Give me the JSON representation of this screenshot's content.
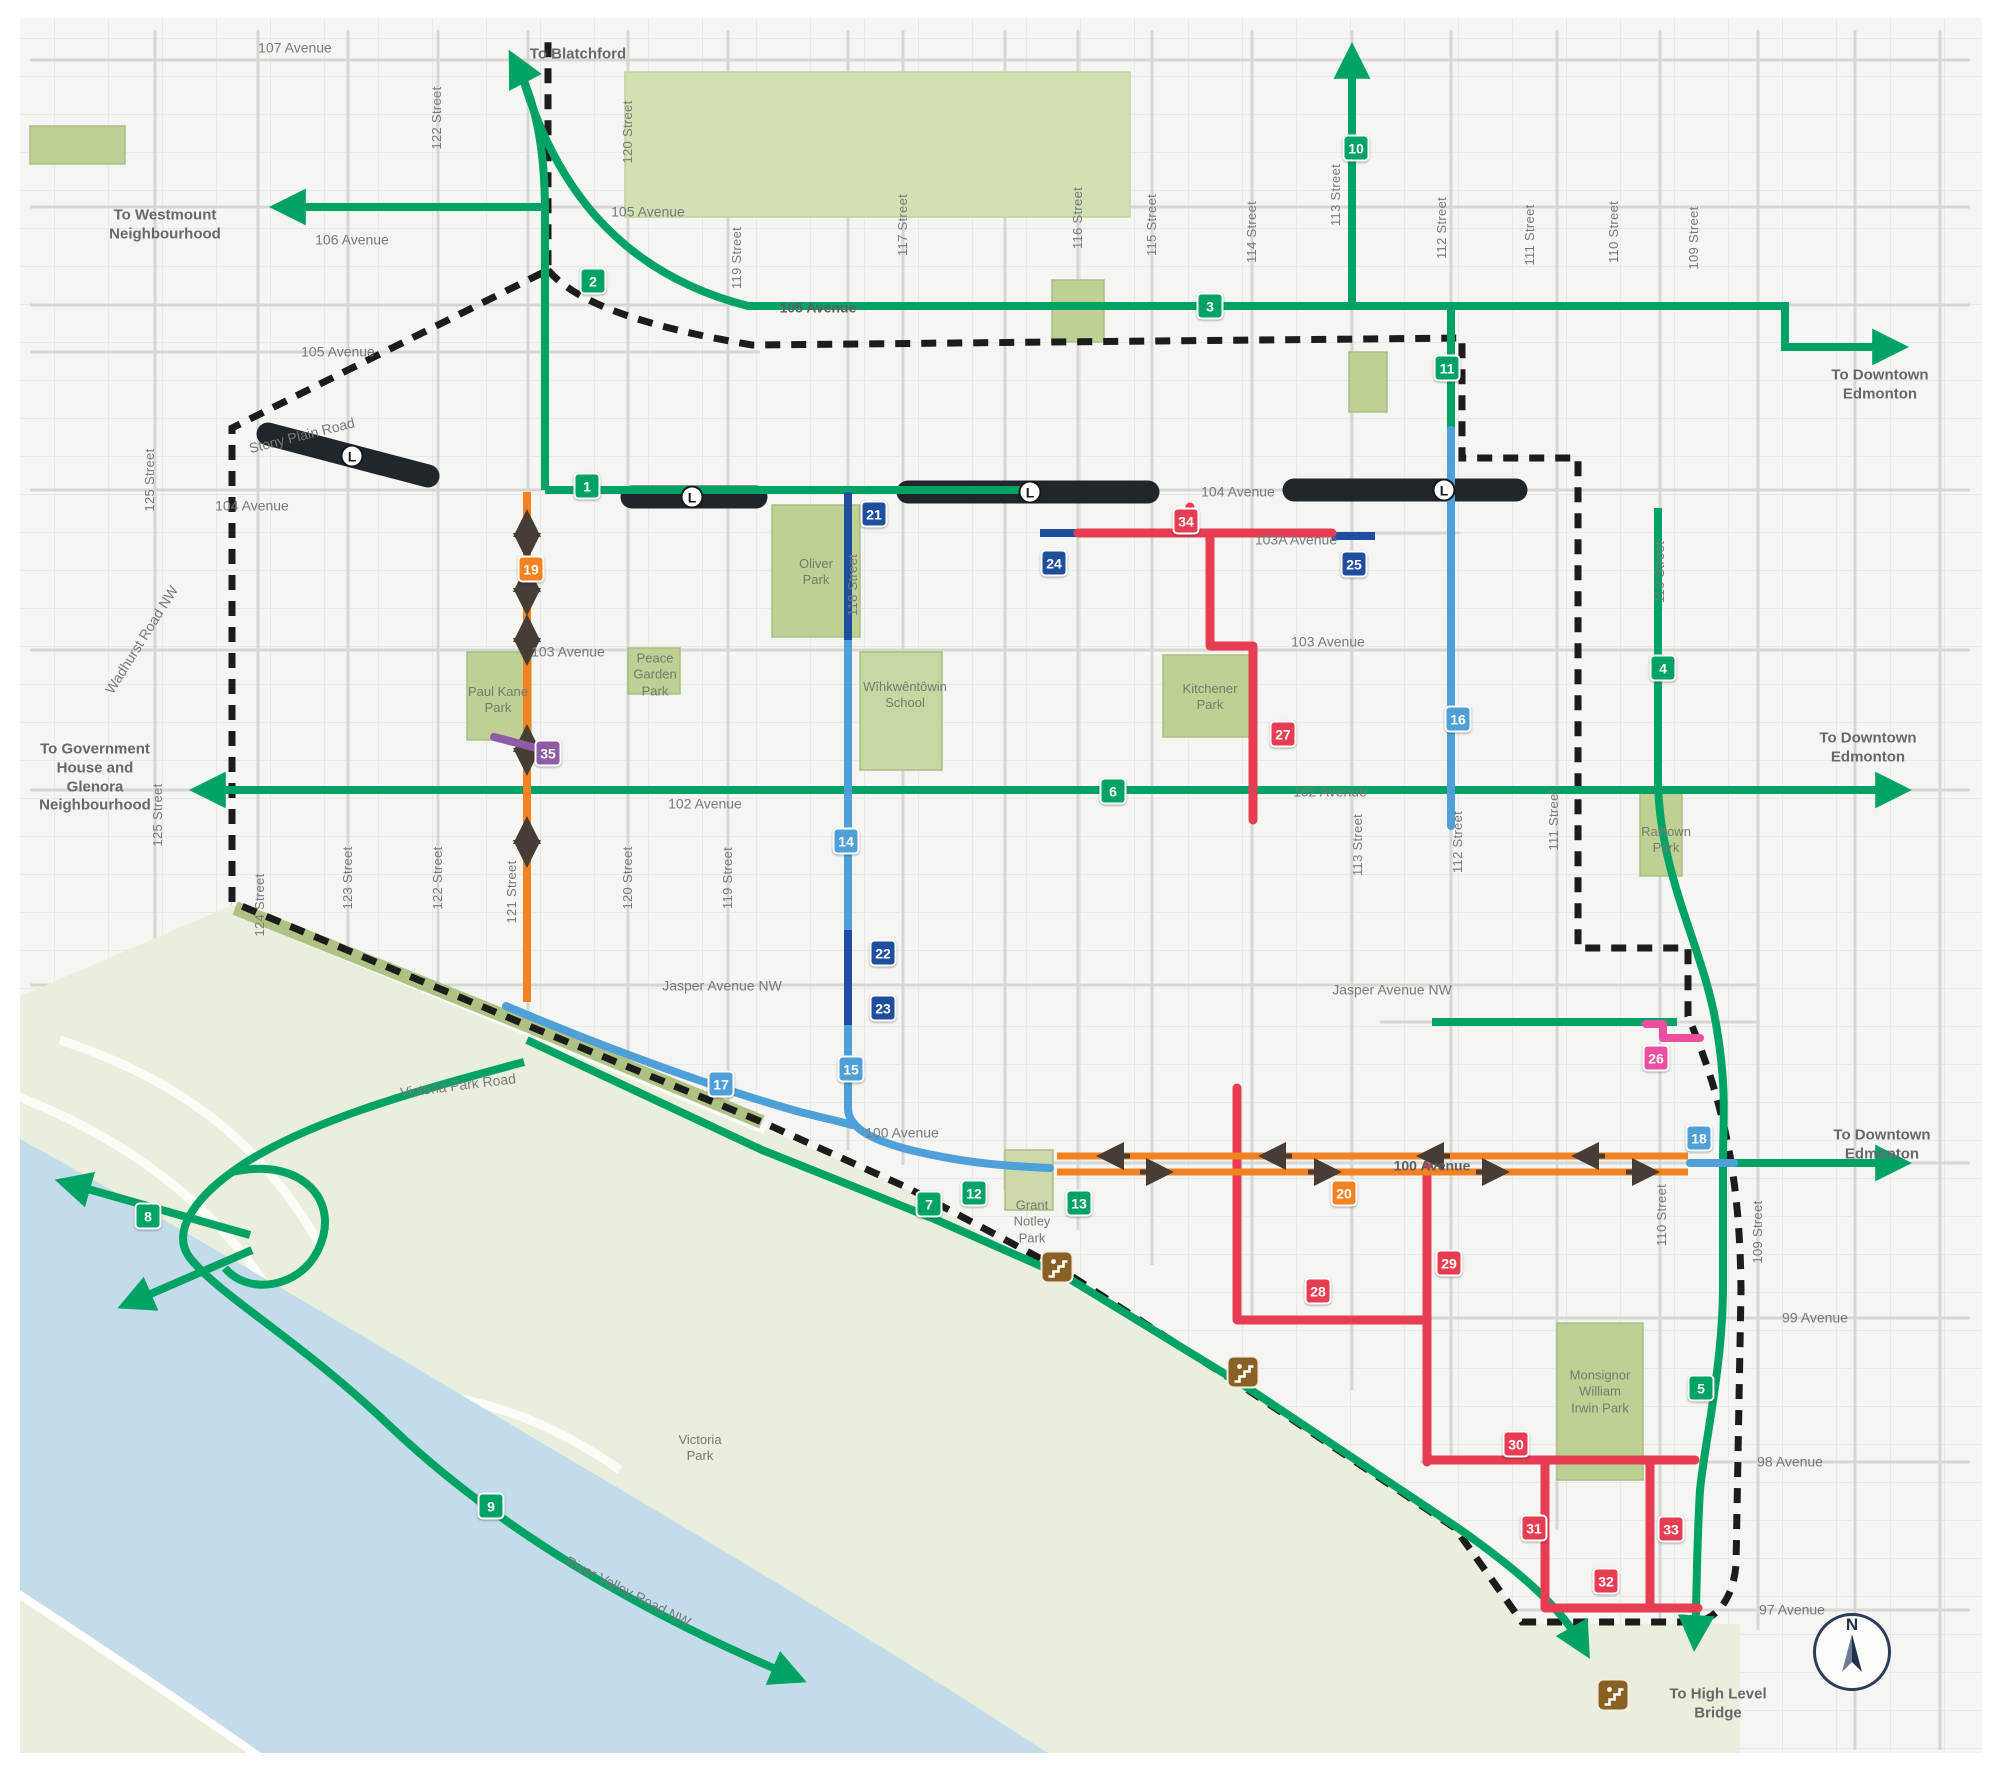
{
  "map_type": "neighbourhood-mobility-network-map",
  "colors": {
    "green_route": "#00a364",
    "blue_route": "#4fa0d8",
    "navy_route": "#1e4e9e",
    "red_route": "#e63d52",
    "orange_route": "#f58220",
    "purple_route": "#8e5ba6",
    "pink_route": "#ec4fa0",
    "lrt_line": "#20262a",
    "boundary": "#1c1c1c",
    "river": "#c3dcec",
    "valley": "#e9efdc",
    "park": "#bdd194"
  },
  "compass": {
    "label": "N"
  },
  "lrt_stations": [
    {
      "label": "L",
      "x": 352,
      "y": 456
    },
    {
      "label": "L",
      "x": 692,
      "y": 497
    },
    {
      "label": "L",
      "x": 1030,
      "y": 492
    },
    {
      "label": "L",
      "x": 1444,
      "y": 490
    }
  ],
  "stairs_icons": [
    {
      "name": "stairs-access-icon",
      "x": 1057,
      "y": 1267
    },
    {
      "name": "stairs-access-icon",
      "x": 1243,
      "y": 1372
    },
    {
      "name": "stairs-access-icon",
      "x": 1613,
      "y": 1695
    }
  ],
  "route_badges": [
    {
      "num": "1",
      "color": "green_route",
      "x": 587,
      "y": 486
    },
    {
      "num": "2",
      "color": "green_route",
      "x": 593,
      "y": 281
    },
    {
      "num": "3",
      "color": "green_route",
      "x": 1210,
      "y": 306
    },
    {
      "num": "4",
      "color": "green_route",
      "x": 1663,
      "y": 668
    },
    {
      "num": "5",
      "color": "green_route",
      "x": 1701,
      "y": 1388
    },
    {
      "num": "6",
      "color": "green_route",
      "x": 1113,
      "y": 791
    },
    {
      "num": "7",
      "color": "green_route",
      "x": 929,
      "y": 1204
    },
    {
      "num": "8",
      "color": "green_route",
      "x": 148,
      "y": 1216
    },
    {
      "num": "9",
      "color": "green_route",
      "x": 491,
      "y": 1506
    },
    {
      "num": "10",
      "color": "green_route",
      "x": 1356,
      "y": 148
    },
    {
      "num": "11",
      "color": "green_route",
      "x": 1447,
      "y": 368
    },
    {
      "num": "12",
      "color": "green_route",
      "x": 974,
      "y": 1193
    },
    {
      "num": "13",
      "color": "green_route",
      "x": 1079,
      "y": 1203
    },
    {
      "num": "14",
      "color": "blue_route",
      "x": 846,
      "y": 841
    },
    {
      "num": "15",
      "color": "blue_route",
      "x": 851,
      "y": 1069
    },
    {
      "num": "16",
      "color": "blue_route",
      "x": 1458,
      "y": 719
    },
    {
      "num": "17",
      "color": "blue_route",
      "x": 721,
      "y": 1084
    },
    {
      "num": "18",
      "color": "blue_route",
      "x": 1699,
      "y": 1138
    },
    {
      "num": "19",
      "color": "orange_route",
      "x": 531,
      "y": 569
    },
    {
      "num": "20",
      "color": "orange_route",
      "x": 1344,
      "y": 1193
    },
    {
      "num": "21",
      "color": "navy_route",
      "x": 874,
      "y": 514
    },
    {
      "num": "22",
      "color": "navy_route",
      "x": 883,
      "y": 953
    },
    {
      "num": "23",
      "color": "navy_route",
      "x": 883,
      "y": 1008
    },
    {
      "num": "24",
      "color": "navy_route",
      "x": 1054,
      "y": 563
    },
    {
      "num": "25",
      "color": "navy_route",
      "x": 1354,
      "y": 564
    },
    {
      "num": "26",
      "color": "pink_route",
      "x": 1656,
      "y": 1058
    },
    {
      "num": "27",
      "color": "red_route",
      "x": 1283,
      "y": 734
    },
    {
      "num": "28",
      "color": "red_route",
      "x": 1318,
      "y": 1291
    },
    {
      "num": "29",
      "color": "red_route",
      "x": 1449,
      "y": 1263
    },
    {
      "num": "30",
      "color": "red_route",
      "x": 1516,
      "y": 1444
    },
    {
      "num": "31",
      "color": "red_route",
      "x": 1534,
      "y": 1528
    },
    {
      "num": "32",
      "color": "red_route",
      "x": 1606,
      "y": 1581
    },
    {
      "num": "33",
      "color": "red_route",
      "x": 1671,
      "y": 1529
    },
    {
      "num": "34",
      "color": "red_route",
      "x": 1186,
      "y": 521
    },
    {
      "num": "35",
      "color": "purple_route",
      "x": 548,
      "y": 753
    }
  ],
  "labels": [
    {
      "text": "107 Avenue",
      "x": 295,
      "y": 48,
      "rot": 0,
      "cls": "avenue"
    },
    {
      "text": "106 Avenue",
      "x": 352,
      "y": 240,
      "rot": 0,
      "cls": "avenue"
    },
    {
      "text": "105 Avenue",
      "x": 338,
      "y": 352,
      "rot": 0,
      "cls": "avenue"
    },
    {
      "text": "105 Avenue",
      "x": 648,
      "y": 212,
      "rot": 0,
      "cls": "avenue"
    },
    {
      "text": "105 Avenue",
      "x": 818,
      "y": 308,
      "rot": 0,
      "cls": "avenue onroute"
    },
    {
      "text": "104 Avenue",
      "x": 252,
      "y": 506,
      "rot": 0,
      "cls": "avenue"
    },
    {
      "text": "104 Avenue",
      "x": 1238,
      "y": 492,
      "rot": 0,
      "cls": "avenue"
    },
    {
      "text": "103A Avenue",
      "x": 1296,
      "y": 540,
      "rot": 0,
      "cls": "avenue"
    },
    {
      "text": "103 Avenue",
      "x": 568,
      "y": 652,
      "rot": 0,
      "cls": "avenue"
    },
    {
      "text": "103 Avenue",
      "x": 1328,
      "y": 642,
      "rot": 0,
      "cls": "avenue"
    },
    {
      "text": "102 Avenue",
      "x": 705,
      "y": 804,
      "rot": 0,
      "cls": "avenue"
    },
    {
      "text": "102 Avenue",
      "x": 1330,
      "y": 792,
      "rot": 0,
      "cls": "avenue"
    },
    {
      "text": "Jasper Avenue NW",
      "x": 722,
      "y": 986,
      "rot": 0,
      "cls": "avenue"
    },
    {
      "text": "Jasper Avenue NW",
      "x": 1392,
      "y": 990,
      "rot": 0,
      "cls": "avenue"
    },
    {
      "text": "100 Avenue",
      "x": 902,
      "y": 1133,
      "rot": 0,
      "cls": "avenue"
    },
    {
      "text": "100 Avenue",
      "x": 1432,
      "y": 1166,
      "rot": 0,
      "cls": "avenue onroute"
    },
    {
      "text": "99 Avenue",
      "x": 1815,
      "y": 1318,
      "rot": 0,
      "cls": "avenue"
    },
    {
      "text": "98 Avenue",
      "x": 1790,
      "y": 1462,
      "rot": 0,
      "cls": "avenue"
    },
    {
      "text": "97 Avenue",
      "x": 1792,
      "y": 1610,
      "rot": 0,
      "cls": "avenue"
    },
    {
      "text": "Stony Plain Road",
      "x": 302,
      "y": 436,
      "rot": -14,
      "cls": "avenue"
    },
    {
      "text": "Victoria Park Road",
      "x": 458,
      "y": 1086,
      "rot": -7,
      "cls": "avenue"
    },
    {
      "text": "River Valley Road NW",
      "x": 628,
      "y": 1592,
      "rot": 27,
      "cls": "avenue"
    },
    {
      "text": "Wadhurst Road NW",
      "x": 142,
      "y": 640,
      "rot": -58,
      "cls": "avenue"
    },
    {
      "text": "125 Street",
      "x": 150,
      "y": 480,
      "rot": -90,
      "cls": "street"
    },
    {
      "text": "122 Street",
      "x": 437,
      "y": 118,
      "rot": -90,
      "cls": "street"
    },
    {
      "text": "120 Street",
      "x": 628,
      "y": 132,
      "rot": -90,
      "cls": "street"
    },
    {
      "text": "119 Street",
      "x": 737,
      "y": 258,
      "rot": -90,
      "cls": "street"
    },
    {
      "text": "117 Street",
      "x": 903,
      "y": 225,
      "rot": -90,
      "cls": "street"
    },
    {
      "text": "116 Street",
      "x": 1078,
      "y": 218,
      "rot": -90,
      "cls": "street"
    },
    {
      "text": "115 Street",
      "x": 1152,
      "y": 225,
      "rot": -90,
      "cls": "street"
    },
    {
      "text": "114 Street",
      "x": 1252,
      "y": 232,
      "rot": -90,
      "cls": "street"
    },
    {
      "text": "113 Street",
      "x": 1336,
      "y": 195,
      "rot": -90,
      "cls": "street"
    },
    {
      "text": "112 Street",
      "x": 1442,
      "y": 228,
      "rot": -90,
      "cls": "street"
    },
    {
      "text": "111 Street",
      "x": 1530,
      "y": 235,
      "rot": -90,
      "cls": "street"
    },
    {
      "text": "110 Street",
      "x": 1614,
      "y": 232,
      "rot": -90,
      "cls": "street"
    },
    {
      "text": "109 Street",
      "x": 1694,
      "y": 238,
      "rot": -90,
      "cls": "street"
    },
    {
      "text": "125 Street",
      "x": 158,
      "y": 815,
      "rot": -90,
      "cls": "street"
    },
    {
      "text": "124 Street",
      "x": 260,
      "y": 905,
      "rot": -90,
      "cls": "street"
    },
    {
      "text": "123 Street",
      "x": 348,
      "y": 878,
      "rot": -90,
      "cls": "street"
    },
    {
      "text": "122 Street",
      "x": 438,
      "y": 878,
      "rot": -90,
      "cls": "street"
    },
    {
      "text": "121 Street",
      "x": 512,
      "y": 892,
      "rot": -90,
      "cls": "street"
    },
    {
      "text": "120 Street",
      "x": 628,
      "y": 878,
      "rot": -90,
      "cls": "street"
    },
    {
      "text": "119 Street",
      "x": 728,
      "y": 878,
      "rot": -90,
      "cls": "street"
    },
    {
      "text": "118 Street",
      "x": 853,
      "y": 585,
      "rot": -90,
      "cls": "street"
    },
    {
      "text": "113 Street",
      "x": 1358,
      "y": 845,
      "rot": -90,
      "cls": "street"
    },
    {
      "text": "112 Street",
      "x": 1458,
      "y": 842,
      "rot": -90,
      "cls": "street"
    },
    {
      "text": "111 Street",
      "x": 1554,
      "y": 820,
      "rot": -90,
      "cls": "street"
    },
    {
      "text": "110 Street",
      "x": 1660,
      "y": 572,
      "rot": -90,
      "cls": "street"
    },
    {
      "text": "110 Street",
      "x": 1662,
      "y": 1215,
      "rot": -90,
      "cls": "street"
    },
    {
      "text": "109 Street",
      "x": 1758,
      "y": 1232,
      "rot": -90,
      "cls": "street"
    },
    {
      "text": "Paul Kane\nPark",
      "x": 498,
      "y": 700,
      "rot": 0,
      "cls": "park"
    },
    {
      "text": "Oliver\nPark",
      "x": 816,
      "y": 572,
      "rot": 0,
      "cls": "park"
    },
    {
      "text": "Peace\nGarden\nPark",
      "x": 655,
      "y": 675,
      "rot": 0,
      "cls": "park"
    },
    {
      "text": "Wîhkwêntôwin\nSchool",
      "x": 905,
      "y": 695,
      "rot": 0,
      "cls": "park"
    },
    {
      "text": "Kitchener\nPark",
      "x": 1210,
      "y": 697,
      "rot": 0,
      "cls": "park"
    },
    {
      "text": "Railtown\nPark",
      "x": 1666,
      "y": 840,
      "rot": 0,
      "cls": "park"
    },
    {
      "text": "Victoria\nPark",
      "x": 700,
      "y": 1448,
      "rot": 0,
      "cls": "park"
    },
    {
      "text": "Monsignor\nWilliam\nIrwin Park",
      "x": 1600,
      "y": 1392,
      "rot": 0,
      "cls": "park"
    },
    {
      "text": "Grant\nNotley\nPark",
      "x": 1032,
      "y": 1222,
      "rot": 0,
      "cls": "park"
    },
    {
      "text": "To Blatchford",
      "x": 578,
      "y": 55,
      "rot": 0,
      "cls": "direction"
    },
    {
      "text": "To Westmount\nNeighbourhood",
      "x": 165,
      "y": 225,
      "rot": 0,
      "cls": "direction"
    },
    {
      "text": "To Downtown\nEdmonton",
      "x": 1880,
      "y": 385,
      "rot": 0,
      "cls": "direction"
    },
    {
      "text": "To Downtown\nEdmonton",
      "x": 1868,
      "y": 748,
      "rot": 0,
      "cls": "direction"
    },
    {
      "text": "To Downtown\nEdmonton",
      "x": 1882,
      "y": 1145,
      "rot": 0,
      "cls": "direction"
    },
    {
      "text": "To Government\nHouse and\nGlenora\nNeighbourhood",
      "x": 95,
      "y": 778,
      "rot": 0,
      "cls": "direction"
    },
    {
      "text": "To High Level\nBridge",
      "x": 1718,
      "y": 1704,
      "rot": 0,
      "cls": "direction"
    }
  ]
}
